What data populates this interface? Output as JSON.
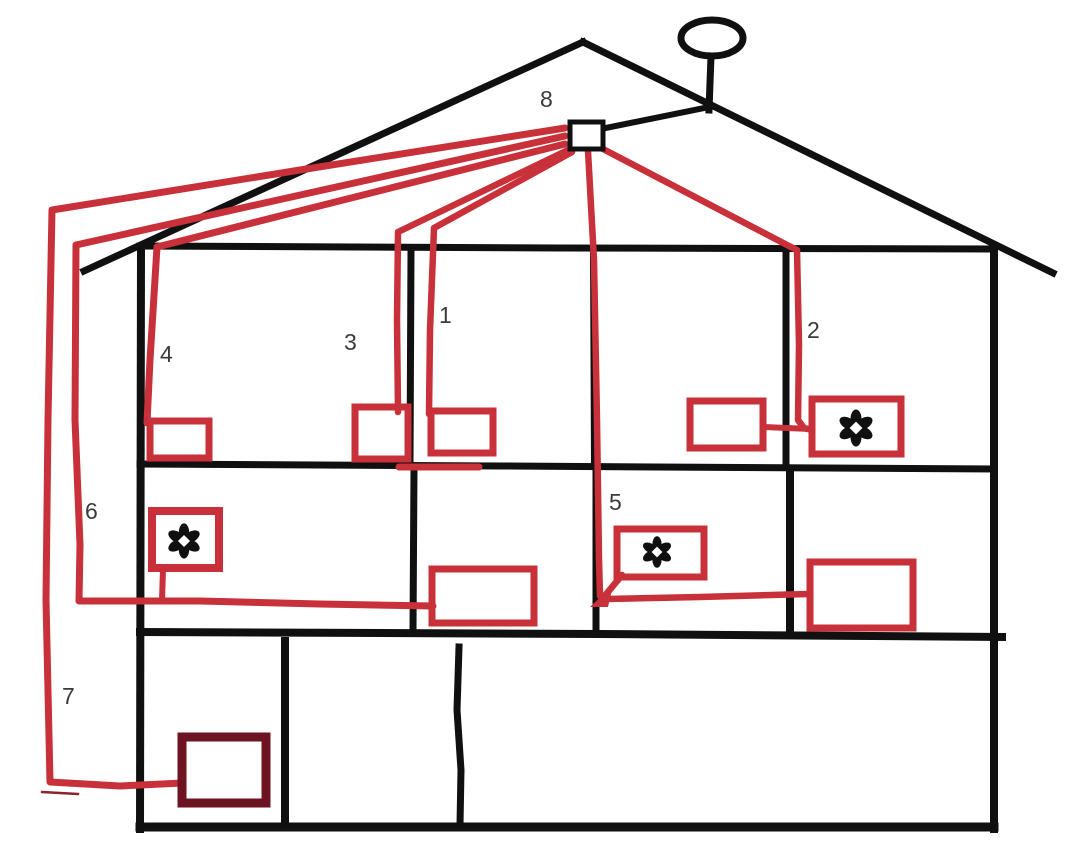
{
  "diagram": {
    "labels": {
      "cable1": "1",
      "cable2": "2",
      "cable3": "3",
      "cable4": "4",
      "cable5": "5",
      "cable6": "6",
      "cable7": "7",
      "distribution_point": "8"
    },
    "colors": {
      "cable_red": "#c8303a",
      "outline_black": "#101010",
      "dark_outlet": "#6e1322",
      "label": "#3b3b3b",
      "background": "#ffffff"
    }
  }
}
